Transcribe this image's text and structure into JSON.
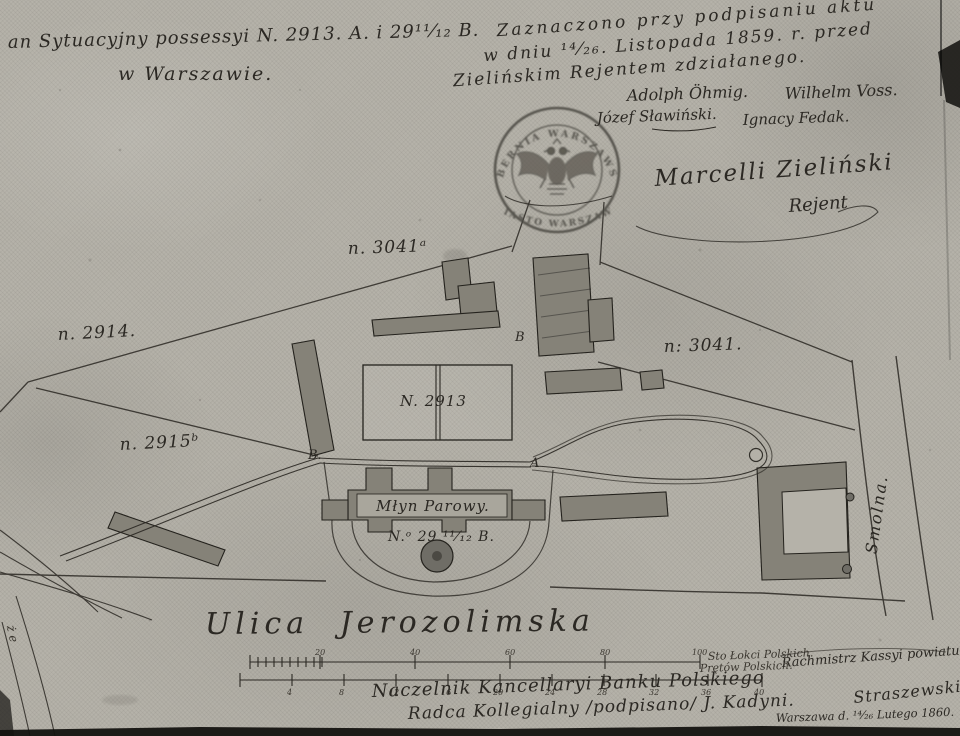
{
  "plan": {
    "title_line1": "an Sytuacyjny possessyi N. 2913. A. i 29¹¹⁄₁₂ B.",
    "title_line2": "w Warszawie.",
    "annotation_line1": "Zaznaczono przy podpisaniu aktu",
    "annotation_line2": "w dniu ¹⁴⁄₂₆. Listopada 1859. r. przed",
    "annotation_line3": "Zielińskim Rejentem zdziałanego.",
    "witness_sig1": "Adolph Öhmig.",
    "witness_sig2": "Wilhelm Voss.",
    "witness_sig3": "Józef Sławiński.",
    "witness_sig4": "Ignacy Fedak.",
    "notary_name": "Marcelli Zieliński",
    "notary_title": "Rejent",
    "seal_top": "GUBERNIA WARSZAWSKA",
    "seal_bottom": "MIASTO WARSZAWA",
    "label_3041a": "n. 3041ᵃ",
    "label_2914": "n. 2914.",
    "label_3041": "n: 3041.",
    "label_2915b": "n. 2915ᵇ",
    "label_2913": "N. 2913",
    "label_mill": "Młyn Parowy.",
    "label_29b": "N.ᵒ 29 ¹¹⁄₁₂ B.",
    "point_b": "B.",
    "point_a": "A",
    "building_letter_b": "B",
    "street_smolna": "Smolna.",
    "street_jerozolimska": "Ulica Jerozolimska",
    "edge_letters": "ż e",
    "scale_upper_label": "Sto Łokci Polskich.",
    "scale_lower_label": "Prętów Polskich.",
    "scale_upper_ticks": [
      "20",
      "40",
      "60",
      "80",
      "100"
    ],
    "scale_lower_ticks": [
      "4",
      "8",
      "12",
      "16",
      "20",
      "24",
      "28",
      "32",
      "36",
      "40"
    ],
    "footer_center1": "Naczelnik Kancellaryi Banku Polskiego",
    "footer_center2": "Radca Kollegialny /podpisano/ J. Kadyni.",
    "footer_right1": "Rachmistrz Kassyi powiatu",
    "footer_right_sig": "Straszewski",
    "footer_right_date": "Warszawa d. ¹⁴⁄₂₆ Lutego 1860.",
    "colors": {
      "paper": "#b5b2a9",
      "ink": "#2b2823",
      "building": "#858278",
      "seal": "#4b4943"
    }
  }
}
